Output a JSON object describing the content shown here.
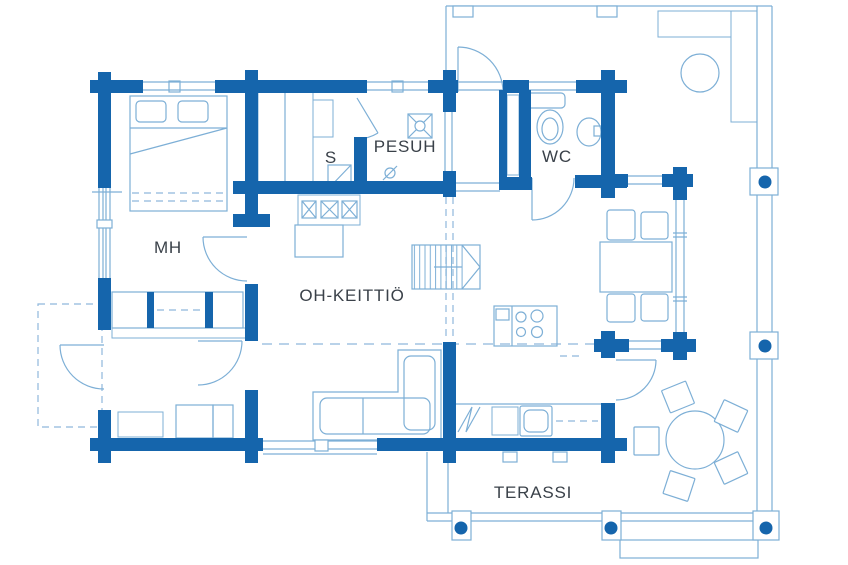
{
  "colors": {
    "wall": "#1565ac",
    "line": "#7dafd6",
    "dash": "#8fb8dc",
    "label": "#3a4149",
    "background": "#ffffff"
  },
  "rooms": [
    {
      "id": "mh",
      "label": "MH"
    },
    {
      "id": "s",
      "label": "S"
    },
    {
      "id": "pesuh",
      "label": "PESUH"
    },
    {
      "id": "wc",
      "label": "WC"
    },
    {
      "id": "oh_keittio",
      "label": "OH-KEITTIÖ"
    },
    {
      "id": "terassi",
      "label": "TERASSI"
    }
  ]
}
